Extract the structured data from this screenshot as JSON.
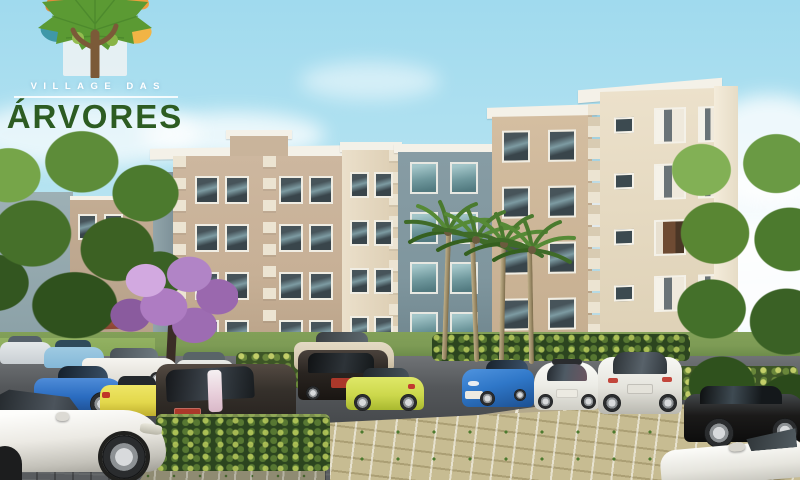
{
  "logo": {
    "subtitle": "VILLAGE DAS",
    "title": "ÁRVORES"
  },
  "palette": {
    "sky_top": "#a0daee",
    "sky_bottom": "#cdeef7",
    "logo_title_green": "#2d5c22",
    "logo_canopy": "#5b9a33",
    "logo_canopy_dark": "#47822a",
    "logo_leaf_orange": "#e08b3c",
    "logo_leaf_orange2": "#ef9f3f",
    "logo_leaf_teal": "#3f98a8",
    "logo_leaf_yellow": "#f1b445",
    "logo_trunk": "#7b5a38",
    "logo_panel": "#eef2f4",
    "building_tan": "#c7b096",
    "building_cream": "#ece1cb",
    "building_gray": "#7f969e",
    "quoin": "#ece4d2",
    "cap_white": "#f4f1e8",
    "grass": "#7d9b55",
    "hedge": "#2c451f",
    "asphalt": "#46494c",
    "paver": "#c7bc92",
    "jac": "#b184c6",
    "palm": "#4a7a2e",
    "palm_trunk": "#9a8a66",
    "car_white": "#eceae4",
    "car_blue": "#2a6cc0",
    "car_yellow": "#e3d84c",
    "car_yellow_green": "#ccd84c",
    "car_dark": "#2a2521",
    "car_black": "#1b1a19",
    "car_tan": "#d8ccb4",
    "car_silver": "#c9cfd3",
    "car_light_blue": "#84b8d8",
    "plate_red": "#ab382a"
  }
}
